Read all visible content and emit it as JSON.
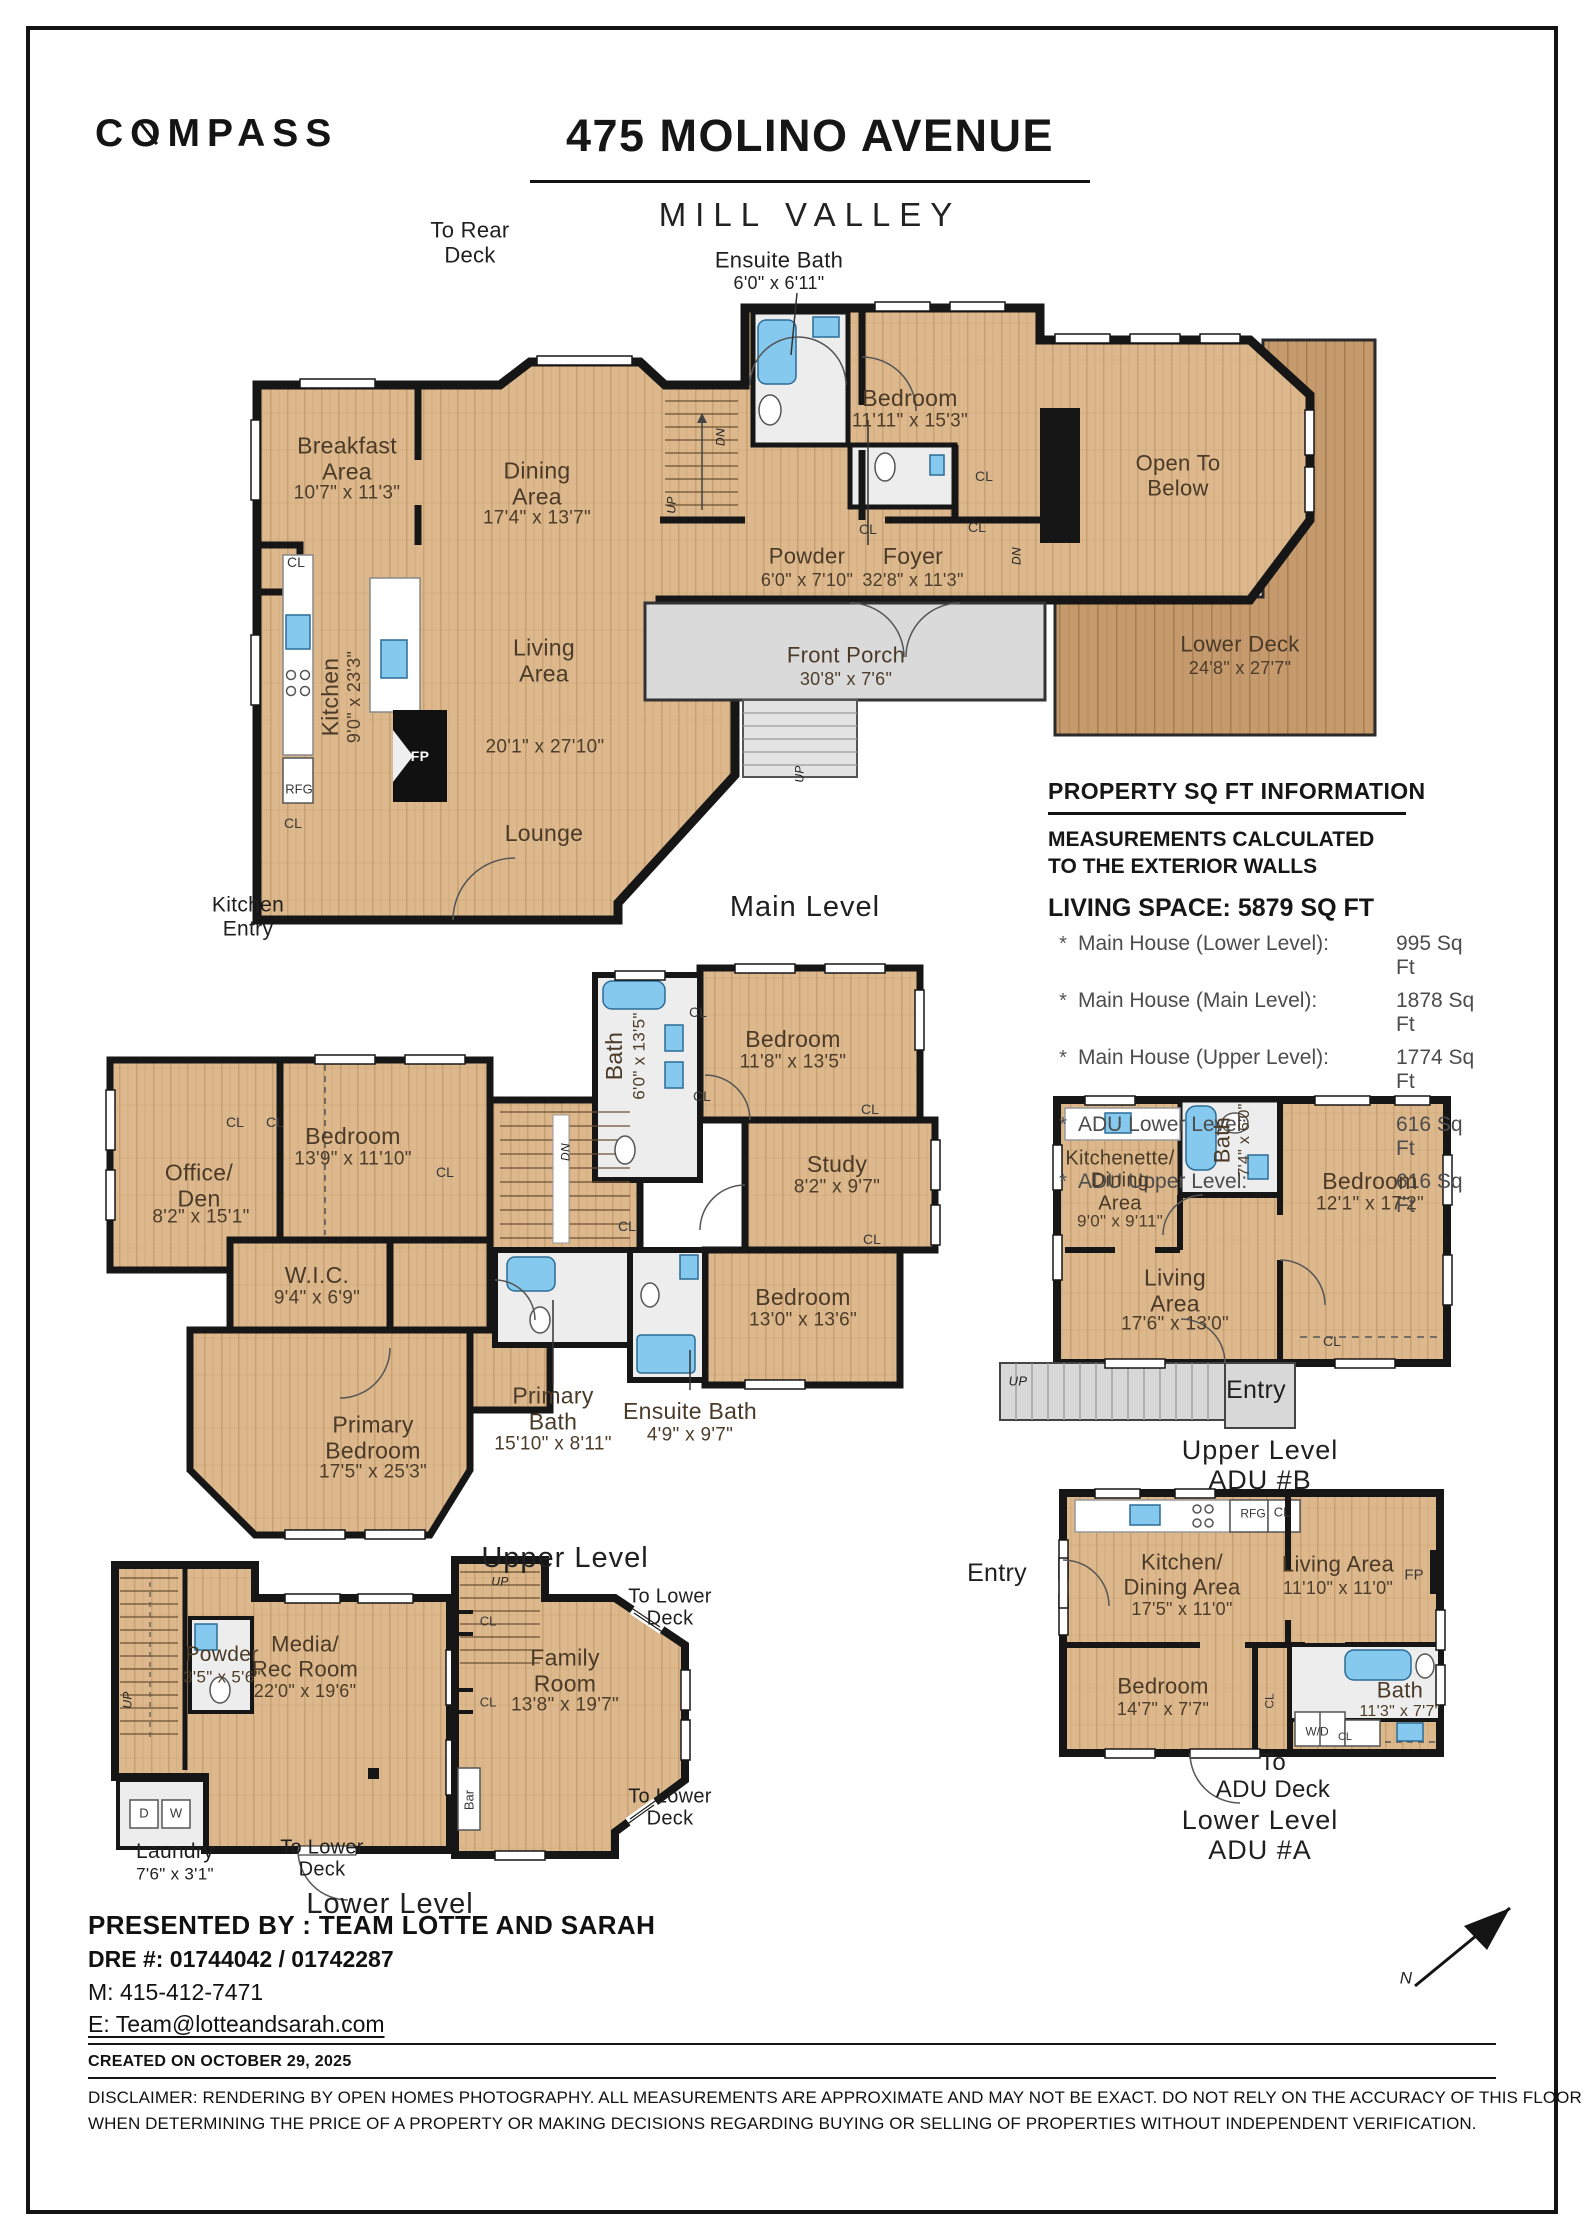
{
  "header": {
    "brand": "COMPASS",
    "title": "475 MOLINO AVENUE",
    "subtitle": "MILL VALLEY"
  },
  "sqft": {
    "title": "PROPERTY SQ FT INFORMATION",
    "note": "MEASUREMENTS CALCULATED\nTO THE EXTERIOR WALLS",
    "living": "LIVING SPACE: 5879 SQ FT",
    "rows": [
      {
        "label": "Main House (Lower Level):",
        "value": "995 Sq Ft"
      },
      {
        "label": "Main House (Main Level):",
        "value": "1878 Sq Ft"
      },
      {
        "label": "Main House (Upper Level):",
        "value": "1774 Sq Ft"
      },
      {
        "label": "ADU Lower Level:",
        "value": "616 Sq Ft",
        "gap": true
      },
      {
        "label": "ADU Upper Level:",
        "value": "616 Sq Ft"
      }
    ]
  },
  "footer": {
    "presented": "PRESENTED BY : TEAM LOTTE AND SARAH",
    "dre": "DRE #: 01744042 / 01742287",
    "mobile": "M: 415-412-7471",
    "email": "E: Team@lotteandsarah.com",
    "created": "CREATED ON OCTOBER 29, 2025",
    "disclaimer1": "DISCLAIMER: RENDERING BY OPEN HOMES PHOTOGRAPHY. ALL MEASUREMENTS ARE APPROXIMATE AND MAY NOT BE EXACT. DO NOT RELY ON THE ACCURACY OF THIS FLOOR PLAN",
    "disclaimer2": "WHEN DETERMINING THE PRICE OF A PROPERTY OR MAKING DECISIONS REGARDING BUYING OR SELLING OF PROPERTIES WITHOUT INDEPENDENT VERIFICATION."
  },
  "labels": [
    {
      "n": "callout-to-rear-deck",
      "t": "To Rear\nDeck",
      "x": 470,
      "y": 243,
      "fs": 22,
      "c": "out"
    },
    {
      "n": "label-ensuite-bath-main",
      "t": "Ensuite Bath",
      "x": 779,
      "y": 261,
      "fs": 22,
      "c": "out"
    },
    {
      "n": "dims-ensuite-bath-main",
      "t": "6'0\" x 6'11\"",
      "x": 779,
      "y": 283,
      "fs": 18,
      "c": "outd"
    },
    {
      "n": "label-breakfast-area",
      "t": "Breakfast\nArea",
      "x": 347,
      "y": 459,
      "fs": 23
    },
    {
      "n": "dims-breakfast-area",
      "t": "10'7\" x 11'3\"",
      "x": 347,
      "y": 493,
      "fs": 19,
      "c": "dim"
    },
    {
      "n": "label-dining-area",
      "t": "Dining\nArea",
      "x": 537,
      "y": 484,
      "fs": 23
    },
    {
      "n": "dims-dining-area",
      "t": "17'4\" x 13'7\"",
      "x": 537,
      "y": 518,
      "fs": 19,
      "c": "dim"
    },
    {
      "n": "label-kitchen",
      "t": "Kitchen",
      "x": 331,
      "y": 697,
      "fs": 23,
      "r": -90
    },
    {
      "n": "dims-kitchen",
      "t": "9'0\" x 23'3\"",
      "x": 354,
      "y": 697,
      "fs": 18,
      "r": -90,
      "c": "dim"
    },
    {
      "n": "label-living-area",
      "t": "Living\nArea",
      "x": 544,
      "y": 661,
      "fs": 23
    },
    {
      "n": "dims-living-area",
      "t": "20'1\" x 27'10\"",
      "x": 545,
      "y": 747,
      "fs": 19,
      "c": "dim"
    },
    {
      "n": "label-lounge",
      "t": "Lounge",
      "x": 544,
      "y": 834,
      "fs": 23
    },
    {
      "n": "label-bedroom-main",
      "t": "Bedroom",
      "x": 910,
      "y": 399,
      "fs": 23
    },
    {
      "n": "dims-bedroom-main",
      "t": "11'11\" x 15'3\"",
      "x": 910,
      "y": 421,
      "fs": 19,
      "c": "dim"
    },
    {
      "n": "label-powder-main",
      "t": "Powder",
      "x": 807,
      "y": 557,
      "fs": 22
    },
    {
      "n": "dims-powder-main",
      "t": "6'0\" x 7'10\"",
      "x": 807,
      "y": 580,
      "fs": 18,
      "c": "dim"
    },
    {
      "n": "label-foyer",
      "t": "Foyer",
      "x": 913,
      "y": 557,
      "fs": 23
    },
    {
      "n": "dims-foyer",
      "t": "32'8\" x 11'3\"",
      "x": 913,
      "y": 580,
      "fs": 18,
      "c": "dim"
    },
    {
      "n": "label-front-porch",
      "t": "Front Porch",
      "x": 846,
      "y": 656,
      "fs": 22
    },
    {
      "n": "dims-front-porch",
      "t": "30'8\" x 7'6\"",
      "x": 846,
      "y": 679,
      "fs": 18,
      "c": "dim"
    },
    {
      "n": "label-lower-deck",
      "t": "Lower Deck",
      "x": 1240,
      "y": 645,
      "fs": 22
    },
    {
      "n": "dims-lower-deck",
      "t": "24'8\" x 27'7\"",
      "x": 1240,
      "y": 668,
      "fs": 18,
      "c": "dim"
    },
    {
      "n": "label-open-to-below",
      "t": "Open To\nBelow",
      "x": 1178,
      "y": 476,
      "fs": 22
    },
    {
      "n": "label-main-level",
      "t": "Main Level",
      "x": 805,
      "y": 907,
      "fs": 29,
      "c": "lvl"
    },
    {
      "n": "label-kitchen-entry",
      "t": "Kitchen\nEntry",
      "x": 248,
      "y": 917,
      "fs": 21,
      "c": "out"
    },
    {
      "t": "CL",
      "x": 296,
      "y": 563,
      "fs": 14,
      "c": "sm"
    },
    {
      "t": "CL",
      "x": 868,
      "y": 530,
      "fs": 14,
      "c": "sm"
    },
    {
      "t": "CL",
      "x": 977,
      "y": 528,
      "fs": 14,
      "c": "sm"
    },
    {
      "t": "CL",
      "x": 984,
      "y": 477,
      "fs": 14,
      "c": "sm"
    },
    {
      "t": "CL",
      "x": 293,
      "y": 824,
      "fs": 14,
      "c": "sm"
    },
    {
      "t": "RFG",
      "x": 299,
      "y": 790,
      "fs": 13,
      "c": "sm"
    },
    {
      "n": "label-fireplace",
      "t": "FP",
      "x": 420,
      "y": 757,
      "fs": 14,
      "c": "wt"
    },
    {
      "t": "UP",
      "x": 800,
      "y": 774,
      "fs": 12,
      "r": -90,
      "c": "it"
    },
    {
      "t": "UP",
      "x": 672,
      "y": 505,
      "fs": 12,
      "r": -90,
      "c": "it"
    },
    {
      "t": "DN",
      "x": 721,
      "y": 437,
      "fs": 12,
      "r": -90,
      "c": "it"
    },
    {
      "t": "DN",
      "x": 1017,
      "y": 556,
      "fs": 12,
      "r": -90,
      "c": "it"
    },
    {
      "n": "label-office-den",
      "t": "Office/\nDen",
      "x": 199,
      "y": 1186,
      "fs": 23
    },
    {
      "n": "dims-office-den",
      "t": "8'2\" x 15'1\"",
      "x": 201,
      "y": 1217,
      "fs": 19,
      "c": "dim"
    },
    {
      "n": "label-bedroom-2",
      "t": "Bedroom",
      "x": 353,
      "y": 1137,
      "fs": 23
    },
    {
      "n": "dims-bedroom-2",
      "t": "13'9\" x 11'10\"",
      "x": 353,
      "y": 1159,
      "fs": 19,
      "c": "dim"
    },
    {
      "n": "label-wic",
      "t": "W.I.C.",
      "x": 317,
      "y": 1276,
      "fs": 23
    },
    {
      "n": "dims-wic",
      "t": "9'4\" x 6'9\"",
      "x": 317,
      "y": 1298,
      "fs": 19,
      "c": "dim"
    },
    {
      "n": "label-bath-upper",
      "t": "Bath",
      "x": 615,
      "y": 1056,
      "fs": 23,
      "r": -90
    },
    {
      "n": "dims-bath-upper",
      "t": "6'0\" x 13'5\"",
      "x": 639,
      "y": 1056,
      "fs": 17,
      "r": -90,
      "c": "dim"
    },
    {
      "n": "label-bedroom-3",
      "t": "Bedroom",
      "x": 793,
      "y": 1040,
      "fs": 23
    },
    {
      "n": "dims-bedroom-3",
      "t": "11'8\" x 13'5\"",
      "x": 793,
      "y": 1062,
      "fs": 19,
      "c": "dim"
    },
    {
      "n": "label-study",
      "t": "Study",
      "x": 837,
      "y": 1165,
      "fs": 23
    },
    {
      "n": "dims-study",
      "t": "8'2\" x 9'7\"",
      "x": 837,
      "y": 1187,
      "fs": 19,
      "c": "dim"
    },
    {
      "n": "label-bedroom-4",
      "t": "Bedroom",
      "x": 803,
      "y": 1298,
      "fs": 23
    },
    {
      "n": "dims-bedroom-4",
      "t": "13'0\" x 13'6\"",
      "x": 803,
      "y": 1320,
      "fs": 19,
      "c": "dim"
    },
    {
      "n": "label-primary-bath",
      "t": "Primary\nBath",
      "x": 553,
      "y": 1409,
      "fs": 23
    },
    {
      "n": "dims-primary-bath",
      "t": "15'10\" x 8'11\"",
      "x": 553,
      "y": 1444,
      "fs": 19,
      "c": "dim"
    },
    {
      "n": "label-ensuite-bath-upper",
      "t": "Ensuite Bath",
      "x": 690,
      "y": 1412,
      "fs": 23
    },
    {
      "n": "dims-ensuite-bath-upper",
      "t": "4'9\" x 9'7\"",
      "x": 690,
      "y": 1435,
      "fs": 19,
      "c": "dim"
    },
    {
      "n": "label-primary-bedroom",
      "t": "Primary\nBedroom",
      "x": 373,
      "y": 1438,
      "fs": 23
    },
    {
      "n": "dims-primary-bedroom",
      "t": "17'5\" x 25'3\"",
      "x": 373,
      "y": 1472,
      "fs": 19,
      "c": "dim"
    },
    {
      "n": "label-upper-level",
      "t": "Upper Level",
      "x": 565,
      "y": 1558,
      "fs": 29,
      "c": "lvl"
    },
    {
      "t": "CL",
      "x": 235,
      "y": 1123,
      "fs": 14,
      "c": "sm"
    },
    {
      "t": "CL",
      "x": 275,
      "y": 1123,
      "fs": 14,
      "c": "sm"
    },
    {
      "t": "CL",
      "x": 445,
      "y": 1173,
      "fs": 14,
      "c": "sm"
    },
    {
      "t": "CL",
      "x": 698,
      "y": 1013,
      "fs": 14,
      "c": "sm"
    },
    {
      "t": "CL",
      "x": 702,
      "y": 1097,
      "fs": 14,
      "c": "sm"
    },
    {
      "t": "CL",
      "x": 870,
      "y": 1110,
      "fs": 14,
      "c": "sm"
    },
    {
      "t": "CL",
      "x": 872,
      "y": 1240,
      "fs": 14,
      "c": "sm"
    },
    {
      "t": "CL",
      "x": 627,
      "y": 1227,
      "fs": 14,
      "c": "sm"
    },
    {
      "t": "DN",
      "x": 566,
      "y": 1152,
      "fs": 12,
      "r": -90,
      "c": "it"
    },
    {
      "n": "label-kitchenette-dining",
      "t": "Kitchenette/\nDining\nArea",
      "x": 1120,
      "y": 1181,
      "fs": 20
    },
    {
      "n": "dims-kitchenette-dining",
      "t": "9'0\" x 9'11\"",
      "x": 1120,
      "y": 1221,
      "fs": 17,
      "c": "dim"
    },
    {
      "n": "label-bath-adu-b",
      "t": "Bath",
      "x": 1223,
      "y": 1140,
      "fs": 22,
      "r": -90
    },
    {
      "n": "dims-bath-adu-b",
      "t": "7'4\" x 6'0\"",
      "x": 1245,
      "y": 1140,
      "fs": 16,
      "r": -90,
      "c": "dim"
    },
    {
      "n": "label-bedroom-adu-b",
      "t": "Bedroom",
      "x": 1370,
      "y": 1182,
      "fs": 23
    },
    {
      "n": "dims-bedroom-adu-b",
      "t": "12'1\" x 17'2\"",
      "x": 1370,
      "y": 1204,
      "fs": 19,
      "c": "dim"
    },
    {
      "n": "label-living-area-adu-b",
      "t": "Living\nArea",
      "x": 1175,
      "y": 1291,
      "fs": 23
    },
    {
      "n": "dims-living-area-adu-b",
      "t": "17'6\" x 13'0\"",
      "x": 1175,
      "y": 1324,
      "fs": 19,
      "c": "dim"
    },
    {
      "t": "CL",
      "x": 1332,
      "y": 1342,
      "fs": 14,
      "c": "sm"
    },
    {
      "n": "label-entry-adu-b",
      "t": "Entry",
      "x": 1256,
      "y": 1390,
      "fs": 25,
      "c": "out"
    },
    {
      "t": "UP",
      "x": 1018,
      "y": 1382,
      "fs": 13,
      "c": "it"
    },
    {
      "n": "label-adu-b-level",
      "t": "Upper Level\nADU #B",
      "x": 1260,
      "y": 1465,
      "fs": 27,
      "c": "lvl"
    },
    {
      "n": "label-entry-adu-a",
      "t": "Entry",
      "x": 997,
      "y": 1573,
      "fs": 25,
      "c": "out"
    },
    {
      "n": "label-kitchen-dining-adu-a",
      "t": "Kitchen/\nDining Area",
      "x": 1182,
      "y": 1575,
      "fs": 22
    },
    {
      "n": "dims-kitchen-dining-adu-a",
      "t": "17'5\" x 11'0\"",
      "x": 1182,
      "y": 1609,
      "fs": 18,
      "c": "dim"
    },
    {
      "n": "label-living-area-adu-a",
      "t": "Living Area",
      "x": 1338,
      "y": 1565,
      "fs": 22
    },
    {
      "n": "dims-living-area-adu-a",
      "t": "11'10\" x 11'0\"",
      "x": 1338,
      "y": 1588,
      "fs": 18,
      "c": "dim"
    },
    {
      "n": "label-fireplace-adu-a",
      "t": "FP",
      "x": 1414,
      "y": 1576,
      "fs": 15,
      "c": "sm"
    },
    {
      "t": "RFG",
      "x": 1253,
      "y": 1514,
      "fs": 12,
      "c": "sm"
    },
    {
      "t": "CL",
      "x": 1282,
      "y": 1513,
      "fs": 13,
      "c": "sm"
    },
    {
      "n": "label-bedroom-adu-a",
      "t": "Bedroom",
      "x": 1163,
      "y": 1687,
      "fs": 22
    },
    {
      "n": "dims-bedroom-adu-a",
      "t": "14'7\" x 7'7\"",
      "x": 1163,
      "y": 1709,
      "fs": 18,
      "c": "dim"
    },
    {
      "t": "CL",
      "x": 1270,
      "y": 1701,
      "fs": 12,
      "r": -90,
      "c": "sm"
    },
    {
      "n": "label-bath-adu-a",
      "t": "Bath",
      "x": 1400,
      "y": 1691,
      "fs": 22
    },
    {
      "n": "dims-bath-adu-a",
      "t": "11'3\" x 7'7\"",
      "x": 1400,
      "y": 1712,
      "fs": 16,
      "c": "dim"
    },
    {
      "t": "W/D",
      "x": 1317,
      "y": 1732,
      "fs": 12,
      "c": "sm"
    },
    {
      "t": "CL",
      "x": 1345,
      "y": 1737,
      "fs": 11,
      "c": "sm"
    },
    {
      "n": "callout-to-adu-deck",
      "t": "To\nADU Deck",
      "x": 1273,
      "y": 1777,
      "fs": 24,
      "c": "out"
    },
    {
      "n": "label-adu-a-level",
      "t": "Lower Level\nADU #A",
      "x": 1260,
      "y": 1835,
      "fs": 27,
      "c": "lvl"
    },
    {
      "n": "label-powder-lower",
      "t": "Powder",
      "x": 222,
      "y": 1655,
      "fs": 21
    },
    {
      "n": "dims-powder-lower",
      "t": "3'5\" x 5'6\"",
      "x": 222,
      "y": 1677,
      "fs": 17,
      "c": "dim"
    },
    {
      "n": "label-media-rec-room",
      "t": "Media/\nRec Room",
      "x": 305,
      "y": 1657,
      "fs": 22
    },
    {
      "n": "dims-media-rec-room",
      "t": "22'0\" x 19'6\"",
      "x": 305,
      "y": 1691,
      "fs": 18,
      "c": "dim"
    },
    {
      "t": "D",
      "x": 144,
      "y": 1814,
      "fs": 13,
      "c": "sm"
    },
    {
      "t": "W",
      "x": 176,
      "y": 1814,
      "fs": 13,
      "c": "sm"
    },
    {
      "n": "label-laundry",
      "t": "Laundry",
      "x": 175,
      "y": 1852,
      "fs": 21,
      "c": "out"
    },
    {
      "n": "dims-laundry",
      "t": "7'6\" x 3'1\"",
      "x": 175,
      "y": 1874,
      "fs": 17,
      "c": "outd"
    },
    {
      "n": "callout-to-lower-deck-1",
      "t": "To Lower\nDeck",
      "x": 322,
      "y": 1859,
      "fs": 20,
      "c": "out"
    },
    {
      "n": "label-lower-level",
      "t": "Lower Level",
      "x": 390,
      "y": 1904,
      "fs": 29,
      "c": "lvl"
    },
    {
      "t": "UP",
      "x": 500,
      "y": 1582,
      "fs": 12,
      "c": "it"
    },
    {
      "t": "UP",
      "x": 128,
      "y": 1700,
      "fs": 12,
      "r": -90,
      "c": "it"
    },
    {
      "t": "CL",
      "x": 488,
      "y": 1622,
      "fs": 13,
      "c": "sm"
    },
    {
      "t": "CL",
      "x": 488,
      "y": 1703,
      "fs": 13,
      "c": "sm"
    },
    {
      "n": "label-family-room",
      "t": "Family\nRoom",
      "x": 565,
      "y": 1671,
      "fs": 23
    },
    {
      "n": "dims-family-room",
      "t": "13'8\" x 19'7\"",
      "x": 565,
      "y": 1705,
      "fs": 19,
      "c": "dim"
    },
    {
      "n": "callout-to-lower-deck-2",
      "t": "To Lower\nDeck",
      "x": 670,
      "y": 1608,
      "fs": 20,
      "c": "out"
    },
    {
      "n": "callout-to-lower-deck-3",
      "t": "To Lower\nDeck",
      "x": 670,
      "y": 1808,
      "fs": 20,
      "c": "out"
    },
    {
      "t": "Bar",
      "x": 470,
      "y": 1800,
      "fs": 13,
      "r": -90,
      "c": "sm"
    },
    {
      "n": "north-arrow-n",
      "t": "N",
      "x": 1406,
      "y": 1978,
      "fs": 17,
      "c": "it"
    }
  ]
}
